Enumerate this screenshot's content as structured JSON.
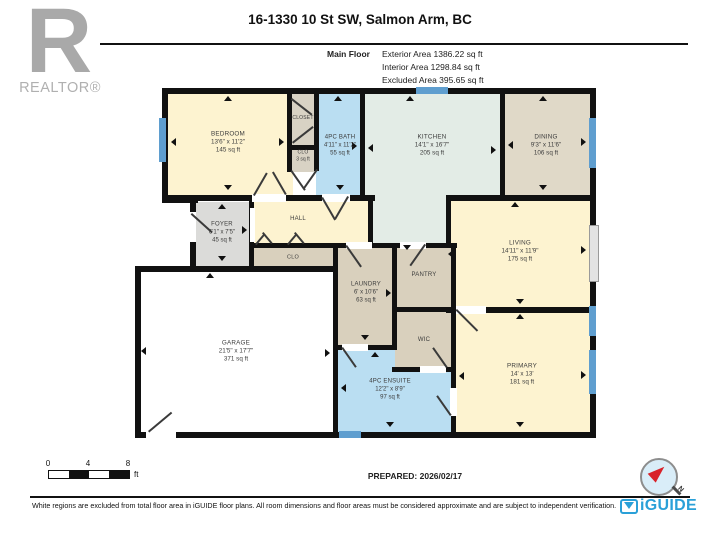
{
  "header": {
    "title": "16-1330 10 St SW, Salmon Arm, BC",
    "floor_label": "Main Floor",
    "area_exterior": "Exterior Area 1386.22 sq ft",
    "area_interior": "Interior Area 1298.84 sq ft",
    "area_excluded": "Excluded Area 395.65 sq ft"
  },
  "branding": {
    "realtor_letter": "R",
    "realtor_text": "REALTOR®",
    "iguide_text": "iGUIDE"
  },
  "footer": {
    "scale_ticks": [
      "0",
      "4",
      "8"
    ],
    "scale_unit": "ft",
    "prepared": "PREPARED: 2026/02/17",
    "compass_label": "N",
    "disclaimer": "White regions are excluded from total floor area in iGUIDE floor plans. All room dimensions and floor areas must be considered approximate and are subject to independent verification."
  },
  "colors": {
    "cream": "#fdf3d0",
    "blue": "#badef2",
    "teal": "#e3ece6",
    "tan": "#d9d0bd",
    "tanLight": "#e0d9c8",
    "gray": "#dbdbd9",
    "grayTan": "#d8d2c4",
    "white": "#ffffff",
    "wall": "#111111",
    "window": "#5f9ecf",
    "iguide_blue": "#2aa0d8",
    "compass_red": "#d8222a"
  },
  "plan": {
    "rooms": [
      {
        "id": "bedroom",
        "color": "cream",
        "x": 165,
        "y": 91,
        "w": 128,
        "h": 107,
        "label": {
          "cx": 228,
          "cy": 143,
          "fs": 6.3,
          "lines": [
            "BEDROOM",
            "13'6\" x 11'2\"",
            "145 sq ft"
          ]
        }
      },
      {
        "id": "closet",
        "color": "grayTan",
        "x": 290,
        "y": 91,
        "w": 27,
        "h": 57,
        "label": {
          "cx": 303,
          "cy": 118,
          "fs": 5,
          "lines": [
            "CLOSET"
          ]
        }
      },
      {
        "id": "closet-small",
        "color": "grayTan",
        "x": 290,
        "y": 148,
        "w": 27,
        "h": 24,
        "label": {
          "cx": 303,
          "cy": 156,
          "fs": 5,
          "lines": [
            "CLO",
            "3 sq ft"
          ]
        }
      },
      {
        "id": "bath",
        "color": "blue",
        "x": 316,
        "y": 91,
        "w": 47,
        "h": 107,
        "label": {
          "cx": 340,
          "cy": 146,
          "fs": 6,
          "lines": [
            "4PC BATH",
            "4'11\" x 11'2\"",
            "55 sq ft"
          ]
        }
      },
      {
        "id": "kitchen",
        "color": "teal",
        "x": 362,
        "y": 91,
        "w": 140,
        "h": 107,
        "label": {
          "cx": 432,
          "cy": 146,
          "fs": 6.3,
          "lines": [
            "KITCHEN",
            "14'1\" x 16'7\"",
            "205 sq ft"
          ]
        }
      },
      {
        "id": "kitchen-ext",
        "color": "teal",
        "x": 371,
        "y": 195,
        "w": 77,
        "h": 51,
        "label": null
      },
      {
        "id": "dining",
        "color": "tanLight",
        "x": 502,
        "y": 91,
        "w": 90,
        "h": 107,
        "label": {
          "cx": 546,
          "cy": 146,
          "fs": 6.3,
          "lines": [
            "DINING",
            "9'3\" x 11'6\"",
            "106 sq ft"
          ]
        }
      },
      {
        "id": "hall",
        "color": "cream",
        "x": 253,
        "y": 198,
        "w": 118,
        "h": 48,
        "label": {
          "cx": 298,
          "cy": 220,
          "fs": 6,
          "lines": [
            "HALL"
          ]
        }
      },
      {
        "id": "foyer",
        "color": "gray",
        "x": 194,
        "y": 202,
        "w": 58,
        "h": 66,
        "label": {
          "cx": 222,
          "cy": 233,
          "fs": 6,
          "lines": [
            "FOYER",
            "6'1\" x 7'5\"",
            "45 sq ft"
          ]
        }
      },
      {
        "id": "closet-row",
        "color": "tan",
        "x": 253,
        "y": 245,
        "w": 82,
        "h": 23,
        "label": {
          "cx": 293,
          "cy": 258,
          "fs": 5.5,
          "lines": [
            "CLO"
          ]
        }
      },
      {
        "id": "living",
        "color": "cream",
        "x": 449,
        "y": 198,
        "w": 143,
        "h": 112,
        "label": {
          "cx": 520,
          "cy": 252,
          "fs": 6.3,
          "lines": [
            "LIVING",
            "14'11\" x 11'9\"",
            "175 sq ft"
          ]
        }
      },
      {
        "id": "laundry",
        "color": "tan",
        "x": 336,
        "y": 245,
        "w": 58,
        "h": 102,
        "label": {
          "cx": 366,
          "cy": 293,
          "fs": 6,
          "lines": [
            "LAUNDRY",
            "6' x 10'6\"",
            "63 sq ft"
          ]
        }
      },
      {
        "id": "pantry",
        "color": "tan",
        "x": 395,
        "y": 245,
        "w": 58,
        "h": 64,
        "label": {
          "cx": 424,
          "cy": 276,
          "fs": 6,
          "lines": [
            "PANTRY"
          ]
        }
      },
      {
        "id": "ensuite",
        "color": "blue",
        "x": 336,
        "y": 348,
        "w": 118,
        "h": 86,
        "label": {
          "cx": 390,
          "cy": 390,
          "fs": 6,
          "lines": [
            "4PC ENSUITE",
            "12'2\" x 8'9\"",
            "97 sq ft"
          ]
        }
      },
      {
        "id": "wic",
        "color": "tan",
        "x": 395,
        "y": 310,
        "w": 58,
        "h": 59,
        "label": {
          "cx": 424,
          "cy": 341,
          "fs": 6,
          "lines": [
            "WIC"
          ]
        }
      },
      {
        "id": "primary",
        "color": "cream",
        "x": 454,
        "y": 311,
        "w": 138,
        "h": 123,
        "label": {
          "cx": 522,
          "cy": 375,
          "fs": 6.3,
          "lines": [
            "PRIMARY",
            "14' x 13'",
            "181 sq ft"
          ]
        }
      },
      {
        "id": "garage",
        "color": "white",
        "x": 139,
        "y": 270,
        "w": 196,
        "h": 164,
        "label": {
          "cx": 236,
          "cy": 352,
          "fs": 6.3,
          "lines": [
            "GARAGE",
            "21'5\" x 17'7\"",
            "371 sq ft"
          ]
        }
      }
    ],
    "walls": [
      [
        162,
        88,
        434,
        6
      ],
      [
        590,
        88,
        6,
        350
      ],
      [
        135,
        432,
        461,
        6
      ],
      [
        162,
        88,
        6,
        115
      ],
      [
        162,
        197,
        36,
        6
      ],
      [
        190,
        200,
        6,
        72
      ],
      [
        135,
        266,
        203,
        6
      ],
      [
        135,
        266,
        6,
        172
      ],
      [
        287,
        91,
        5,
        81
      ],
      [
        314,
        91,
        5,
        80
      ],
      [
        360,
        91,
        5,
        110
      ],
      [
        500,
        91,
        5,
        107
      ],
      [
        368,
        198,
        5,
        49
      ],
      [
        446,
        195,
        5,
        52
      ],
      [
        249,
        200,
        5,
        70
      ],
      [
        333,
        243,
        5,
        194
      ],
      [
        392,
        243,
        5,
        106
      ],
      [
        451,
        243,
        5,
        193
      ],
      [
        162,
        195,
        213,
        6
      ],
      [
        446,
        195,
        150,
        6
      ],
      [
        287,
        145,
        32,
        5
      ],
      [
        252,
        243,
        205,
        5
      ],
      [
        333,
        345,
        64,
        5
      ],
      [
        392,
        307,
        64,
        5
      ],
      [
        392,
        367,
        64,
        5
      ],
      [
        446,
        307,
        150,
        6
      ]
    ],
    "windows": [
      [
        159,
        118,
        7,
        44
      ],
      [
        416,
        87,
        32,
        7
      ],
      [
        589,
        118,
        7,
        50
      ],
      [
        589,
        306,
        7,
        30
      ],
      [
        589,
        350,
        7,
        44
      ],
      [
        339,
        431,
        22,
        7
      ]
    ],
    "door_gaps": [
      {
        "r": [
          252,
          194,
          34,
          8
        ]
      },
      {
        "r": [
          322,
          194,
          28,
          8
        ]
      },
      {
        "r": [
          190,
          212,
          6,
          30
        ]
      },
      {
        "r": [
          250,
          208,
          5,
          34
        ]
      },
      {
        "r": [
          346,
          242,
          26,
          7
        ]
      },
      {
        "r": [
          400,
          242,
          26,
          7
        ]
      },
      {
        "r": [
          342,
          344,
          26,
          7
        ]
      },
      {
        "r": [
          420,
          366,
          26,
          7
        ]
      },
      {
        "r": [
          456,
          306,
          30,
          8
        ]
      },
      {
        "r": [
          450,
          388,
          7,
          28
        ]
      },
      {
        "r": [
          146,
          431,
          30,
          8
        ]
      },
      {
        "r": [
          589,
          225,
          8,
          55
        ],
        "patio": true
      }
    ],
    "door_lines": [
      [
        253,
        195,
        -60,
        26
      ],
      [
        285,
        195,
        -120,
        26
      ],
      [
        292,
        98,
        38,
        26
      ],
      [
        292,
        142,
        -38,
        26
      ],
      [
        292,
        170,
        55,
        24
      ],
      [
        318,
        170,
        125,
        24
      ],
      [
        323,
        197,
        60,
        26
      ],
      [
        349,
        197,
        120,
        26
      ],
      [
        192,
        213,
        42,
        28
      ],
      [
        255,
        244,
        -50,
        14
      ],
      [
        271,
        244,
        -130,
        14
      ],
      [
        287,
        244,
        -50,
        14
      ],
      [
        303,
        244,
        -130,
        14
      ],
      [
        347,
        245,
        55,
        26
      ],
      [
        426,
        245,
        125,
        26
      ],
      [
        343,
        347,
        55,
        24
      ],
      [
        446,
        368,
        -125,
        24
      ],
      [
        457,
        309,
        45,
        30
      ],
      [
        450,
        416,
        -125,
        24
      ],
      [
        148,
        431,
        -40,
        30
      ]
    ],
    "arrows": [
      {
        "x": 228,
        "y": 96,
        "d": "up"
      },
      {
        "x": 338,
        "y": 96,
        "d": "up"
      },
      {
        "x": 410,
        "y": 96,
        "d": "up"
      },
      {
        "x": 543,
        "y": 96,
        "d": "up"
      },
      {
        "x": 222,
        "y": 204,
        "d": "up"
      },
      {
        "x": 210,
        "y": 273,
        "d": "up"
      },
      {
        "x": 515,
        "y": 202,
        "d": "up"
      },
      {
        "x": 375,
        "y": 352,
        "d": "up"
      },
      {
        "x": 520,
        "y": 314,
        "d": "up"
      },
      {
        "x": 228,
        "y": 189,
        "d": "down"
      },
      {
        "x": 340,
        "y": 189,
        "d": "down"
      },
      {
        "x": 543,
        "y": 189,
        "d": "down"
      },
      {
        "x": 222,
        "y": 260,
        "d": "down"
      },
      {
        "x": 407,
        "y": 249,
        "d": "down"
      },
      {
        "x": 365,
        "y": 339,
        "d": "down"
      },
      {
        "x": 520,
        "y": 303,
        "d": "down"
      },
      {
        "x": 390,
        "y": 426,
        "d": "down"
      },
      {
        "x": 520,
        "y": 426,
        "d": "down"
      },
      {
        "x": 171,
        "y": 142,
        "d": "left"
      },
      {
        "x": 368,
        "y": 148,
        "d": "left"
      },
      {
        "x": 508,
        "y": 145,
        "d": "left"
      },
      {
        "x": 141,
        "y": 351,
        "d": "left"
      },
      {
        "x": 341,
        "y": 388,
        "d": "left"
      },
      {
        "x": 459,
        "y": 376,
        "d": "left"
      },
      {
        "x": 448,
        "y": 254,
        "d": "left"
      },
      {
        "x": 283,
        "y": 142,
        "d": "right"
      },
      {
        "x": 356,
        "y": 146,
        "d": "right"
      },
      {
        "x": 495,
        "y": 150,
        "d": "right"
      },
      {
        "x": 585,
        "y": 142,
        "d": "right"
      },
      {
        "x": 585,
        "y": 250,
        "d": "right"
      },
      {
        "x": 390,
        "y": 293,
        "d": "right"
      },
      {
        "x": 329,
        "y": 353,
        "d": "right"
      },
      {
        "x": 585,
        "y": 375,
        "d": "right"
      },
      {
        "x": 246,
        "y": 230,
        "d": "right"
      }
    ]
  }
}
